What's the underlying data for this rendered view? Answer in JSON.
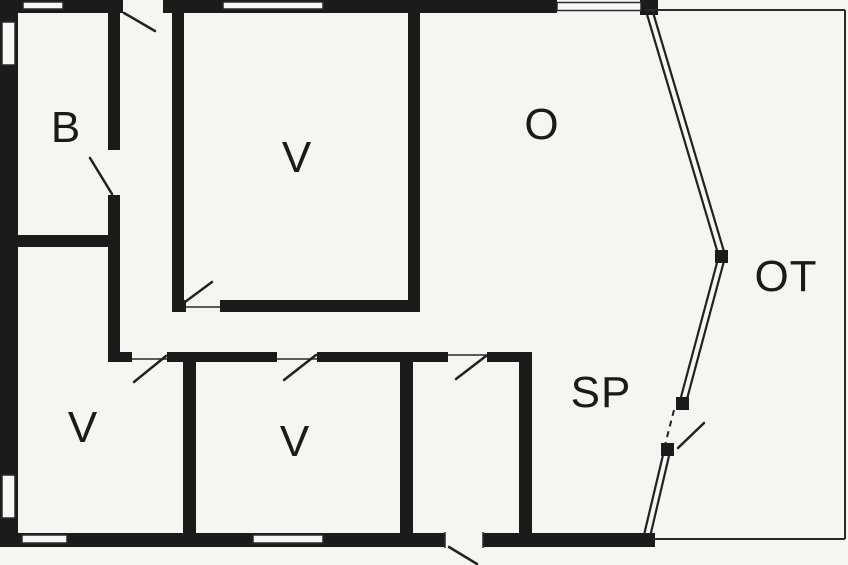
{
  "plan": {
    "type": "architectural-floor-plan",
    "background_color": "#f6f5f1",
    "wall_color": "#1d1b19",
    "thin_line_color": "#2b2b2b",
    "rooms": [
      {
        "id": "room-b",
        "label": "B"
      },
      {
        "id": "room-v-main",
        "label": "V"
      },
      {
        "id": "room-o",
        "label": "O"
      },
      {
        "id": "room-ot",
        "label": "OT"
      },
      {
        "id": "room-v-left",
        "label": "V"
      },
      {
        "id": "room-v-middle",
        "label": "V"
      },
      {
        "id": "room-sp",
        "label": "SP"
      }
    ]
  }
}
